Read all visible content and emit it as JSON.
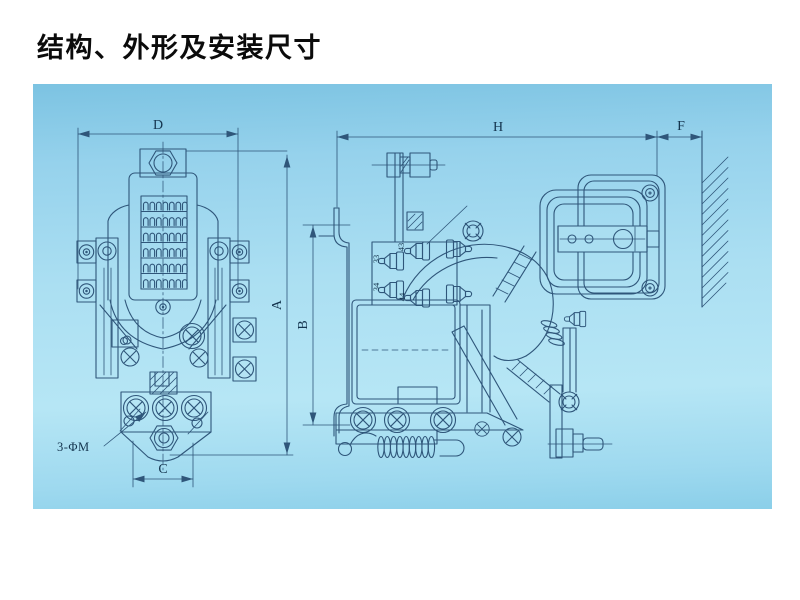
{
  "page": {
    "title": "结构、外形及安装尺寸",
    "panel_color_top": "#7cc3e2",
    "panel_color_mid": "#b6e6f5",
    "panel_color_bottom": "#8bcfe9",
    "line_color": "#2f567a",
    "text_color": "#14344e"
  },
  "front_view": {
    "dim_width_label": "D",
    "dim_height_label": "A",
    "dim_hole_span_label": "C",
    "mounting_hole_note": "3-ΦM"
  },
  "side_view": {
    "dim_width_label": "H",
    "dim_wall_gap_label": "F",
    "dim_bracket_height_label": "B",
    "aux_terminal_labels": {
      "t43": "43",
      "t33": "33",
      "t34": "34",
      "t44": "44"
    }
  }
}
